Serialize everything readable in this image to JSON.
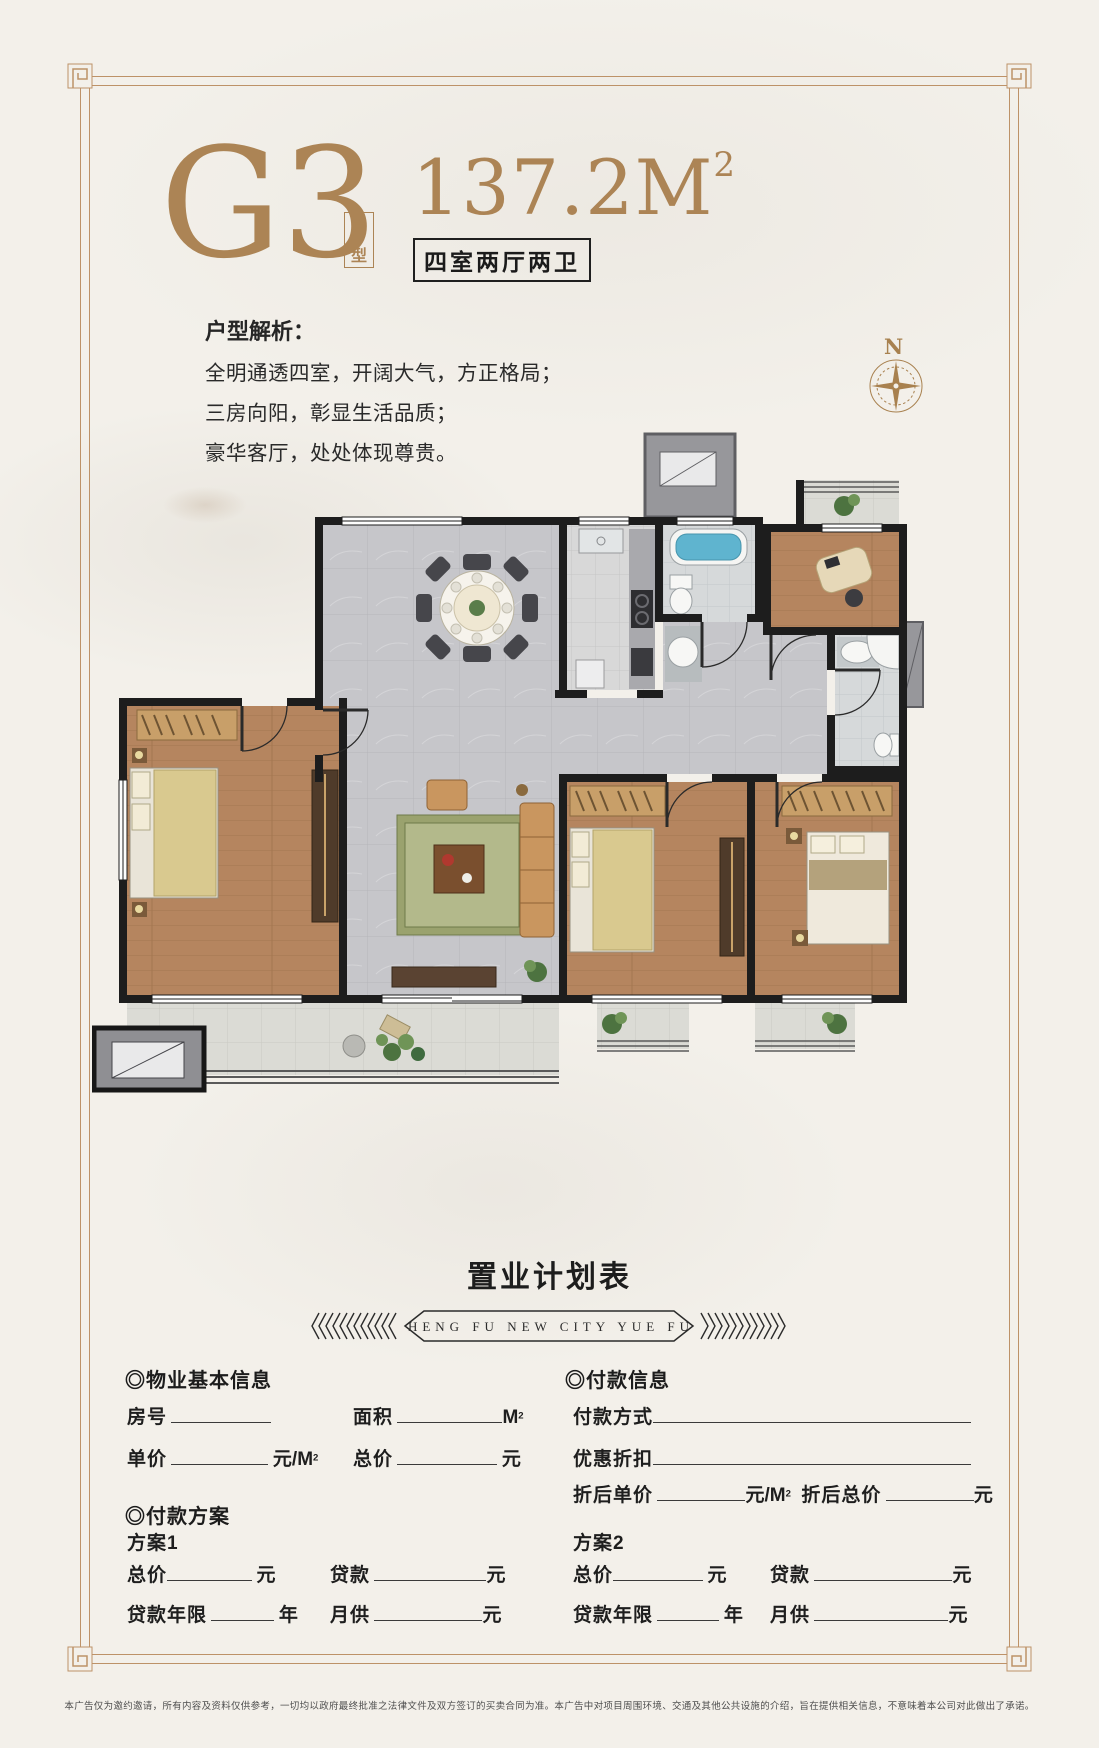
{
  "header": {
    "code": "G3",
    "code_tag": "户型",
    "area": "137.2M",
    "area_sup": "2",
    "spec": "四室两厅两卫"
  },
  "analysis": {
    "title": "户型解析：",
    "lines": [
      "全明通透四室，开阔大气，方正格局；",
      "三房向阳，彰显生活品质；",
      "豪华客厅，处处体现尊贵。"
    ]
  },
  "compass": {
    "north": "N"
  },
  "plan_section": {
    "title": "置业计划表",
    "banner": "HENG FU NEW CITY YUE FU"
  },
  "form": {
    "bullet": "◎",
    "property_heading": "物业基本信息",
    "payment_heading": "付款信息",
    "plan_heading": "付款方案",
    "labels": {
      "room_no": "房号",
      "area": "面积",
      "unit_price": "单价",
      "total_price": "总价",
      "pay_method": "付款方式",
      "discount": "优惠折扣",
      "disc_unit_price": "折后单价",
      "disc_total_price": "折后总价",
      "plan1": "方案1",
      "plan2": "方案2",
      "loan": "贷款",
      "loan_years": "贷款年限",
      "monthly_pay": "月供"
    },
    "units": {
      "yuan": "元",
      "year": "年",
      "m": "M",
      "per_m": "元/M",
      "sup": "2"
    }
  },
  "footer": {
    "disclaimer": "本广告仅为邀约邀请，所有内容及资料仅供参考，一切均以政府最终批准之法律文件及双方签订的买卖合同为准。本广告中对项目周围环境、交通及其他公共设施的介绍，旨在提供相关信息，不意味着本公司对此做出了承诺。"
  },
  "colors": {
    "gold": "#ac8455",
    "frame": "#bd9268",
    "ink": "#1f1f1f"
  }
}
